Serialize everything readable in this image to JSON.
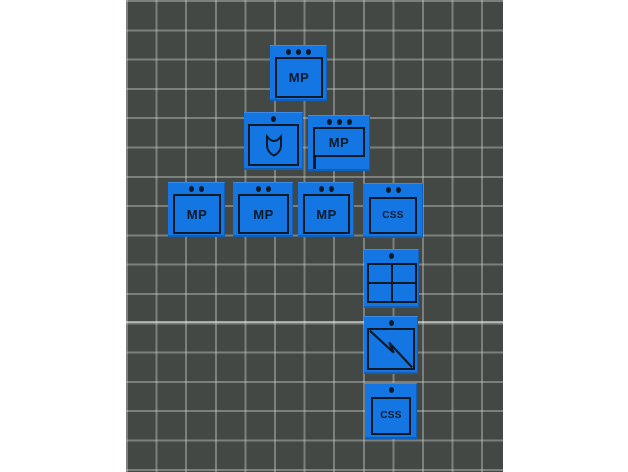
{
  "colors": {
    "page_bg": "#ffffff",
    "plate_bg": "#434845",
    "grid_line": "#d6dad6",
    "bright_grid_line": "#f6f9f6",
    "token_blue": "#1476e3",
    "symbol_dark": "#0c1a28"
  },
  "plate": {
    "grid_cell_px": 29.5,
    "left_px": 126,
    "width_px": 377
  },
  "tiles": [
    {
      "name": "unit-tile-mp-hq",
      "label": "MP",
      "dots": 3,
      "symbol": "text",
      "x": 270,
      "y": 45,
      "w": 57,
      "h": 56
    },
    {
      "name": "unit-tile-shield",
      "label": "",
      "dots": 1,
      "symbol": "shield",
      "x": 244,
      "y": 112,
      "w": 59,
      "h": 58
    },
    {
      "name": "unit-tile-mp-flag",
      "label": "MP",
      "dots": 3,
      "symbol": "flag",
      "x": 308,
      "y": 115,
      "w": 62,
      "h": 56
    },
    {
      "name": "unit-tile-mp-1",
      "label": "MP",
      "dots": 2,
      "symbol": "text",
      "x": 168,
      "y": 182,
      "w": 57,
      "h": 55
    },
    {
      "name": "unit-tile-mp-2",
      "label": "MP",
      "dots": 2,
      "symbol": "text",
      "x": 233,
      "y": 182,
      "w": 60,
      "h": 55
    },
    {
      "name": "unit-tile-mp-3",
      "label": "MP",
      "dots": 2,
      "symbol": "text",
      "x": 298,
      "y": 182,
      "w": 56,
      "h": 55
    },
    {
      "name": "unit-tile-css-1",
      "label": "CSS",
      "dots": 2,
      "symbol": "text",
      "x": 363,
      "y": 183,
      "w": 60,
      "h": 55,
      "small": true
    },
    {
      "name": "unit-tile-quartered",
      "label": "",
      "dots": 1,
      "symbol": "quad",
      "x": 364,
      "y": 249,
      "w": 55,
      "h": 59
    },
    {
      "name": "unit-tile-signal",
      "label": "",
      "dots": 1,
      "symbol": "bolt",
      "x": 364,
      "y": 316,
      "w": 54,
      "h": 58
    },
    {
      "name": "unit-tile-css-2",
      "label": "CSS",
      "dots": 1,
      "symbol": "text",
      "x": 365,
      "y": 383,
      "w": 52,
      "h": 56,
      "small": true
    }
  ]
}
